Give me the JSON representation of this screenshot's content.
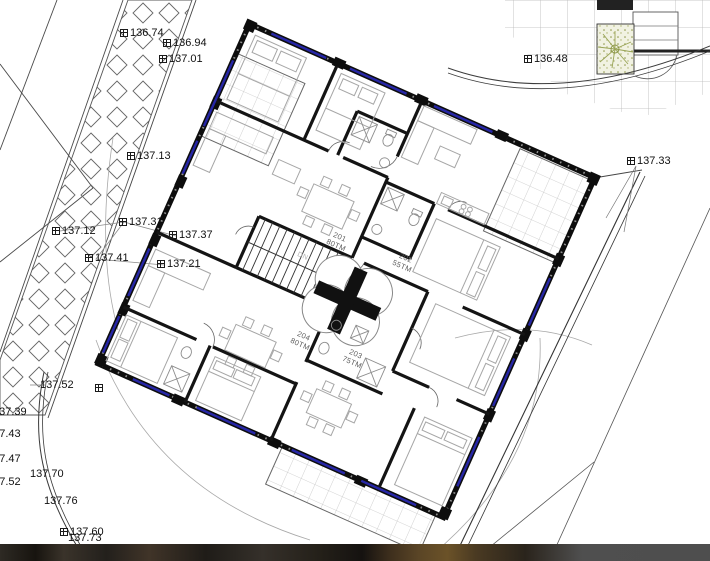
{
  "drawing": {
    "stairs_direction_label": "DN",
    "colors": {
      "wall": "#0d0d0d",
      "window_glazing": "#2626a6",
      "furniture_line": "#a6a6a6",
      "terrace_grid": "#c6c6c6",
      "greenery": "#99a455",
      "photo_strip": "#4e4e4e"
    }
  },
  "apartments": [
    {
      "number": "201",
      "area": "80TM",
      "x": 338,
      "y": 241
    },
    {
      "number": "202",
      "area": "55TM",
      "x": 404,
      "y": 262
    },
    {
      "number": "204",
      "area": "80TM",
      "x": 302,
      "y": 340
    },
    {
      "number": "203",
      "area": "75TM",
      "x": 354,
      "y": 358
    }
  ],
  "survey_points": [
    {
      "value": "136.74",
      "x": 120,
      "y": 33,
      "glyph": true
    },
    {
      "value": "136.94",
      "x": 163,
      "y": 43,
      "glyph": true
    },
    {
      "value": "137.01",
      "x": 159,
      "y": 59,
      "glyph": true
    },
    {
      "value": "136.48",
      "x": 524,
      "y": 59,
      "glyph": true
    },
    {
      "value": "137.13",
      "x": 127,
      "y": 156,
      "glyph": true
    },
    {
      "value": "137.33",
      "x": 627,
      "y": 161,
      "glyph": true
    },
    {
      "value": "137.31",
      "x": 119,
      "y": 222,
      "glyph": true
    },
    {
      "value": "137.12",
      "x": 52,
      "y": 231,
      "glyph": true
    },
    {
      "value": "137.37",
      "x": 169,
      "y": 235,
      "glyph": true
    },
    {
      "value": "137.41",
      "x": 85,
      "y": 258,
      "glyph": true
    },
    {
      "value": "137.21",
      "x": 157,
      "y": 264,
      "glyph": true
    },
    {
      "value": "137.52",
      "x": 40,
      "y": 385,
      "glyph": false
    },
    {
      "value": "",
      "x": 95,
      "y": 390,
      "glyph": true
    },
    {
      "value": "137.39",
      "x": -7,
      "y": 412,
      "glyph": false
    },
    {
      "value": "137.43",
      "x": -13,
      "y": 434,
      "glyph": false
    },
    {
      "value": "137.47",
      "x": -13,
      "y": 459,
      "glyph": false
    },
    {
      "value": "137.70",
      "x": 30,
      "y": 474,
      "glyph": false
    },
    {
      "value": "137.52",
      "x": -13,
      "y": 482,
      "glyph": false
    },
    {
      "value": "137.76",
      "x": 44,
      "y": 501,
      "glyph": false
    },
    {
      "value": "137.60",
      "x": 60,
      "y": 532,
      "glyph": true
    },
    {
      "value": "137.73",
      "x": 68,
      "y": 538,
      "glyph": false
    }
  ]
}
